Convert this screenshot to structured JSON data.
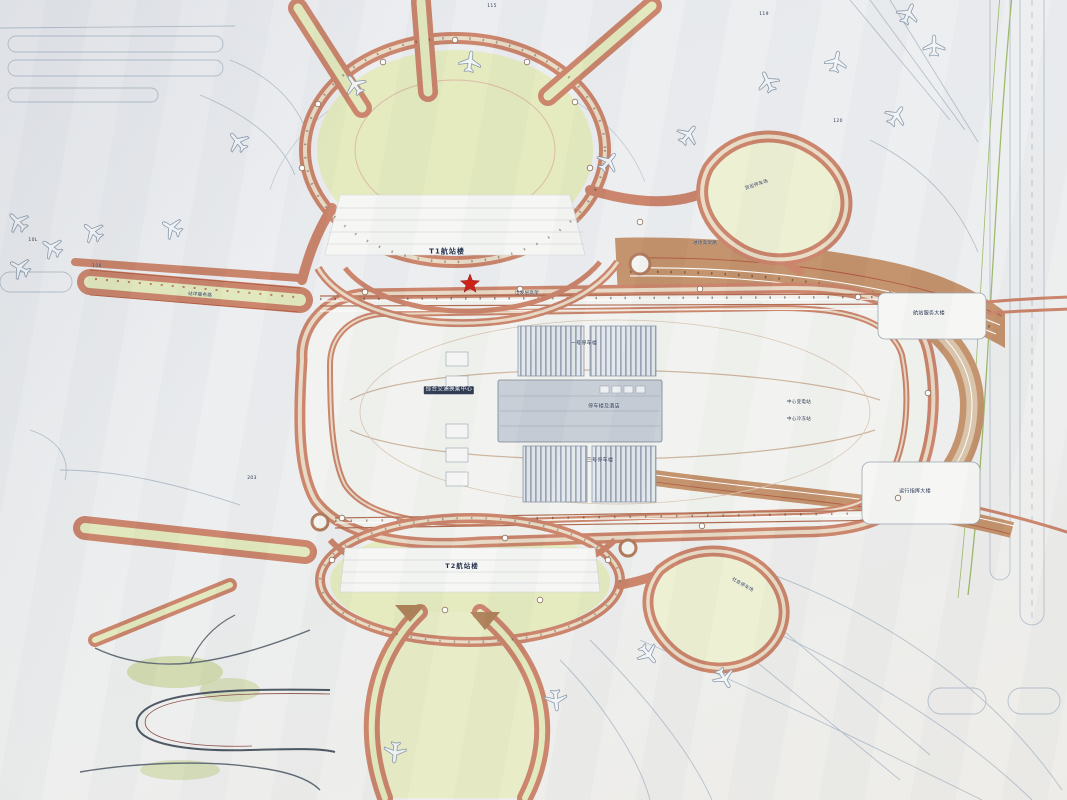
{
  "meta": {
    "kind": "photographed airport master plan drawing",
    "language": "zh"
  },
  "palette": {
    "paper": "#e9ebee",
    "road_salmon": "#c98268",
    "road_edge": "#a8543c",
    "corridor_tan": "#c2906a",
    "greenery": "#e4eabd",
    "parking_gray": "#9aa6b6",
    "building_gray": "#c6cdd6",
    "linework": "#b3bfca",
    "star_red": "#d01f16",
    "label_ink": "#22304d"
  },
  "terminals": {
    "t1": "T1航站楼",
    "t2": "T2航站楼"
  },
  "star_marker": {
    "x": 470,
    "y": 283
  },
  "labels": [
    {
      "id": "gtc",
      "text": "综合交通换乘中心",
      "x": 449,
      "y": 390,
      "fs": 5.5,
      "chip": true
    },
    {
      "id": "p1",
      "text": "一号停车楼",
      "x": 584,
      "y": 344,
      "fs": 5
    },
    {
      "id": "hotel",
      "text": "停车楼及酒店",
      "x": 604,
      "y": 407,
      "fs": 5
    },
    {
      "id": "p2",
      "text": "二号停车楼",
      "x": 600,
      "y": 461,
      "fs": 5
    },
    {
      "id": "svc",
      "text": "航站服务大楼",
      "x": 929,
      "y": 314,
      "fs": 5
    },
    {
      "id": "ops",
      "text": "运行指挥大楼",
      "x": 915,
      "y": 492,
      "fs": 5
    },
    {
      "id": "sub1",
      "text": "中心变电站",
      "x": 799,
      "y": 403,
      "fs": 4.5
    },
    {
      "id": "sub2",
      "text": "中心冷冻站",
      "x": 799,
      "y": 420,
      "fs": 4.5
    },
    {
      "id": "cargo",
      "text": "货运停车场",
      "x": 757,
      "y": 186,
      "fs": 4.5,
      "rot": -18
    },
    {
      "id": "apron",
      "text": "站坪服务路",
      "x": 200,
      "y": 296,
      "fs": 4.5,
      "rot": 4
    },
    {
      "id": "viaduct",
      "text": "进场高架路",
      "x": 705,
      "y": 244,
      "fs": 4.5
    },
    {
      "id": "depart",
      "text": "出发层高架",
      "x": 527,
      "y": 294,
      "fs": 4.5
    },
    {
      "id": "separk",
      "text": "社会停车场",
      "x": 742,
      "y": 586,
      "fs": 4.5,
      "rot": 30
    },
    {
      "id": "g115",
      "text": "115",
      "x": 492,
      "y": 7,
      "fs": 4.5
    },
    {
      "id": "g119",
      "text": "119",
      "x": 764,
      "y": 15,
      "fs": 4.5
    },
    {
      "id": "g120",
      "text": "120",
      "x": 838,
      "y": 122,
      "fs": 4.5
    },
    {
      "id": "g108",
      "text": "108",
      "x": 97,
      "y": 267,
      "fs": 4.5
    },
    {
      "id": "g10l",
      "text": "10L",
      "x": 33,
      "y": 241,
      "fs": 4.5
    },
    {
      "id": "g203",
      "text": "203",
      "x": 252,
      "y": 479,
      "fs": 4.5
    }
  ],
  "aircraft": [
    {
      "x": 355,
      "y": 85,
      "r": -35
    },
    {
      "x": 470,
      "y": 62,
      "r": 8
    },
    {
      "x": 608,
      "y": 162,
      "r": 40
    },
    {
      "x": 688,
      "y": 135,
      "r": 38
    },
    {
      "x": 768,
      "y": 82,
      "r": -25
    },
    {
      "x": 836,
      "y": 62,
      "r": 12
    },
    {
      "x": 896,
      "y": 116,
      "r": 35
    },
    {
      "x": 934,
      "y": 46,
      "r": 0
    },
    {
      "x": 908,
      "y": 14,
      "r": 25
    },
    {
      "x": 238,
      "y": 142,
      "r": -40
    },
    {
      "x": 172,
      "y": 228,
      "r": -60
    },
    {
      "x": 93,
      "y": 232,
      "r": -50
    },
    {
      "x": 52,
      "y": 248,
      "r": -55
    },
    {
      "x": 20,
      "y": 268,
      "r": -60
    },
    {
      "x": 18,
      "y": 222,
      "r": -45
    },
    {
      "x": 648,
      "y": 654,
      "r": 140
    },
    {
      "x": 724,
      "y": 678,
      "r": 150
    },
    {
      "x": 556,
      "y": 700,
      "r": 175
    },
    {
      "x": 395,
      "y": 752,
      "r": 185
    }
  ]
}
